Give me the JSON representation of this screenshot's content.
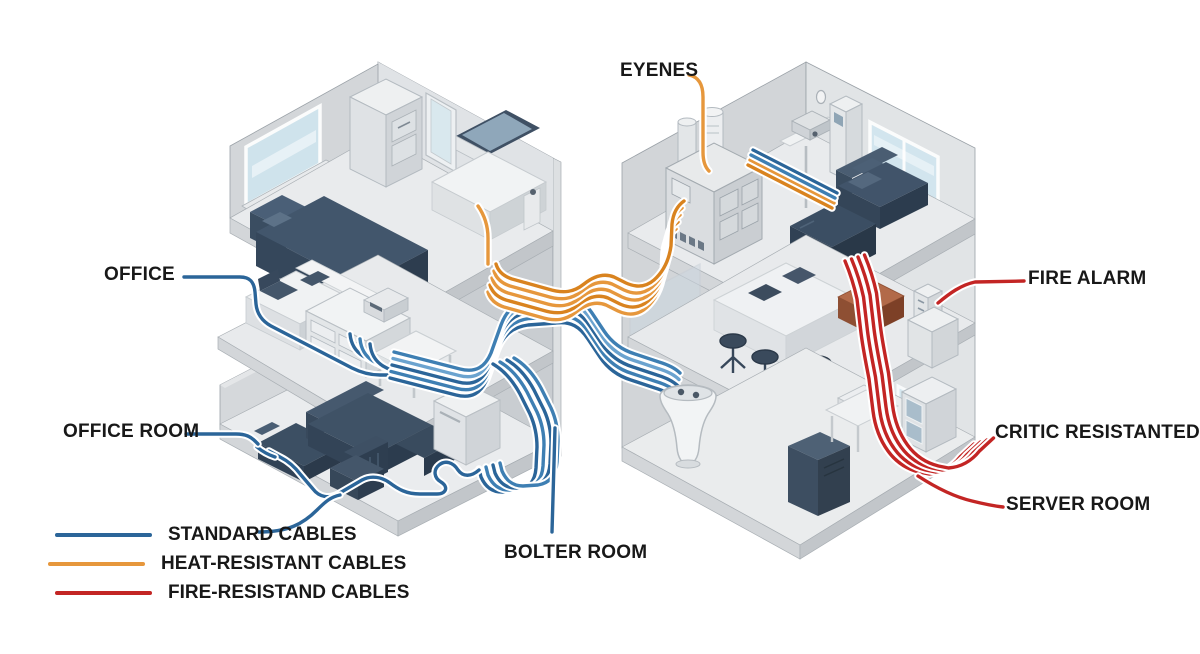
{
  "title": "Building cable routing diagram",
  "colors": {
    "standard": "#2b6599",
    "standard_mid": "#3e7fb3",
    "standard_light": "#6ba3cf",
    "heat": "#e6973c",
    "heat_dark": "#d9831f",
    "fire": "#c32524",
    "text": "#181818"
  },
  "labels": {
    "eyenes": "EYENES",
    "office": "OFFICE",
    "office_room": "OFFICE ROOM",
    "bolter_room": "BOLTER ROOM",
    "fire_alarm": "FIRE ALARM",
    "critic_resistanted": "CRITIC RESISTANTED",
    "server_room": "SERVER ROOM"
  },
  "legend": {
    "items": [
      {
        "id": "standard",
        "label": "STANDARD CABLES"
      },
      {
        "id": "heat",
        "label": "HEAT-RESISTANT CABLES"
      },
      {
        "id": "fire",
        "label": "FIRE-RESISTAND CABLES"
      }
    ]
  }
}
